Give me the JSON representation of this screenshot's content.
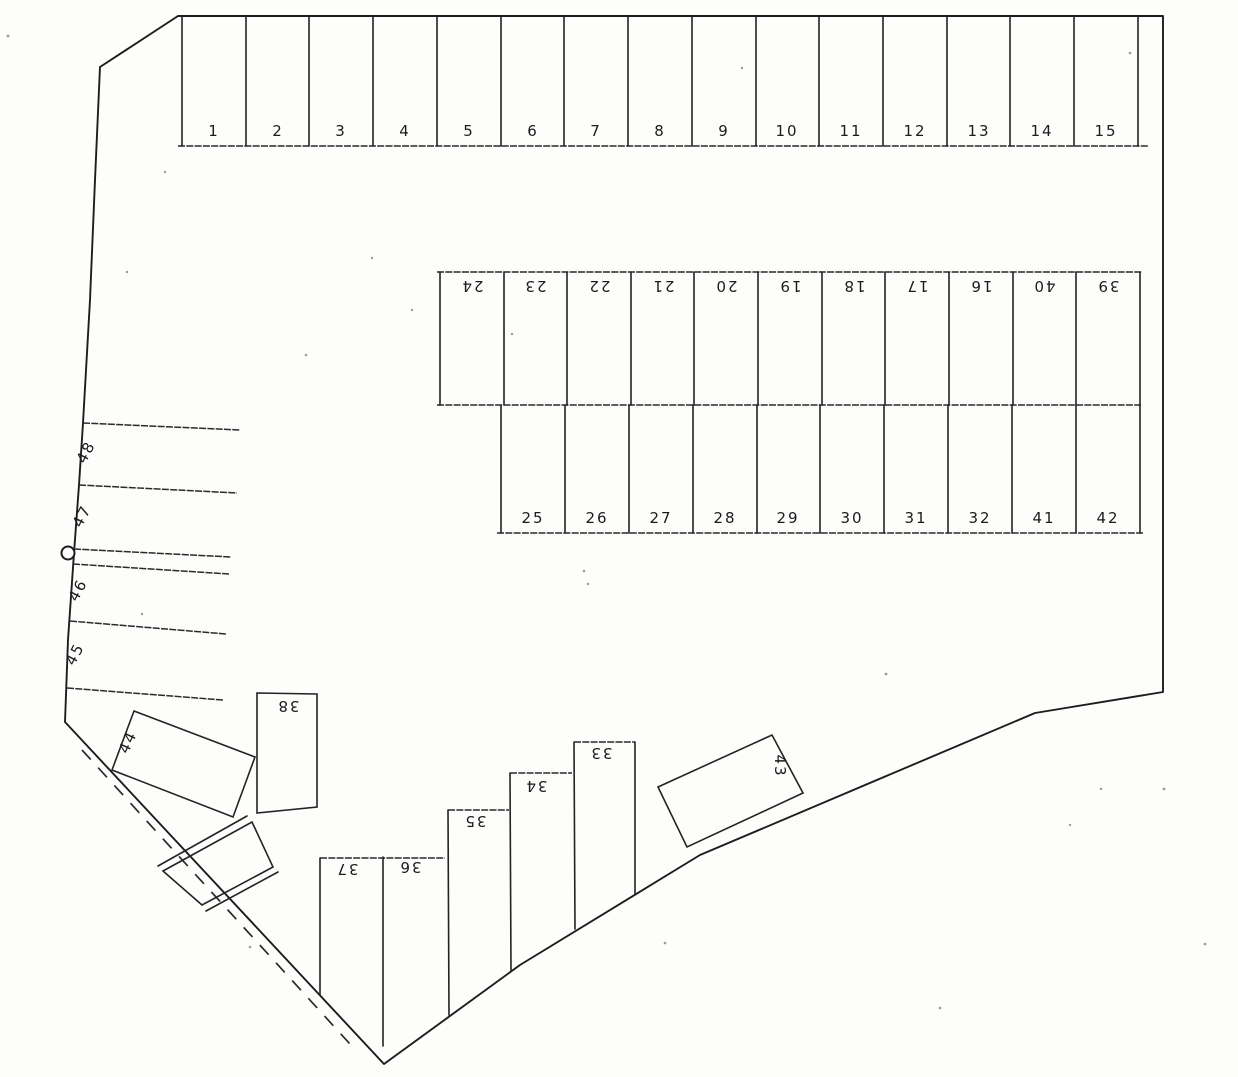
{
  "plan": {
    "top_row_labels": [
      "1",
      "2",
      "3",
      "4",
      "5",
      "6",
      "7",
      "8",
      "9",
      "10",
      "11",
      "12",
      "13",
      "14",
      "15"
    ],
    "middle_upper_labels": [
      "24",
      "23",
      "22",
      "21",
      "20",
      "19",
      "18",
      "17",
      "16",
      "40",
      "39"
    ],
    "middle_lower_labels": [
      "25",
      "26",
      "27",
      "28",
      "29",
      "30",
      "31",
      "32",
      "41",
      "42"
    ],
    "left_column_labels": [
      "48",
      "47",
      "46",
      "45"
    ],
    "bottom_step_labels": [
      "37",
      "36",
      "35",
      "34",
      "33"
    ],
    "space_38_label": "38",
    "space_44_label": "44",
    "space_43_label": "43",
    "ink_color": "#232323",
    "paper_color": "#fdfdfc"
  }
}
